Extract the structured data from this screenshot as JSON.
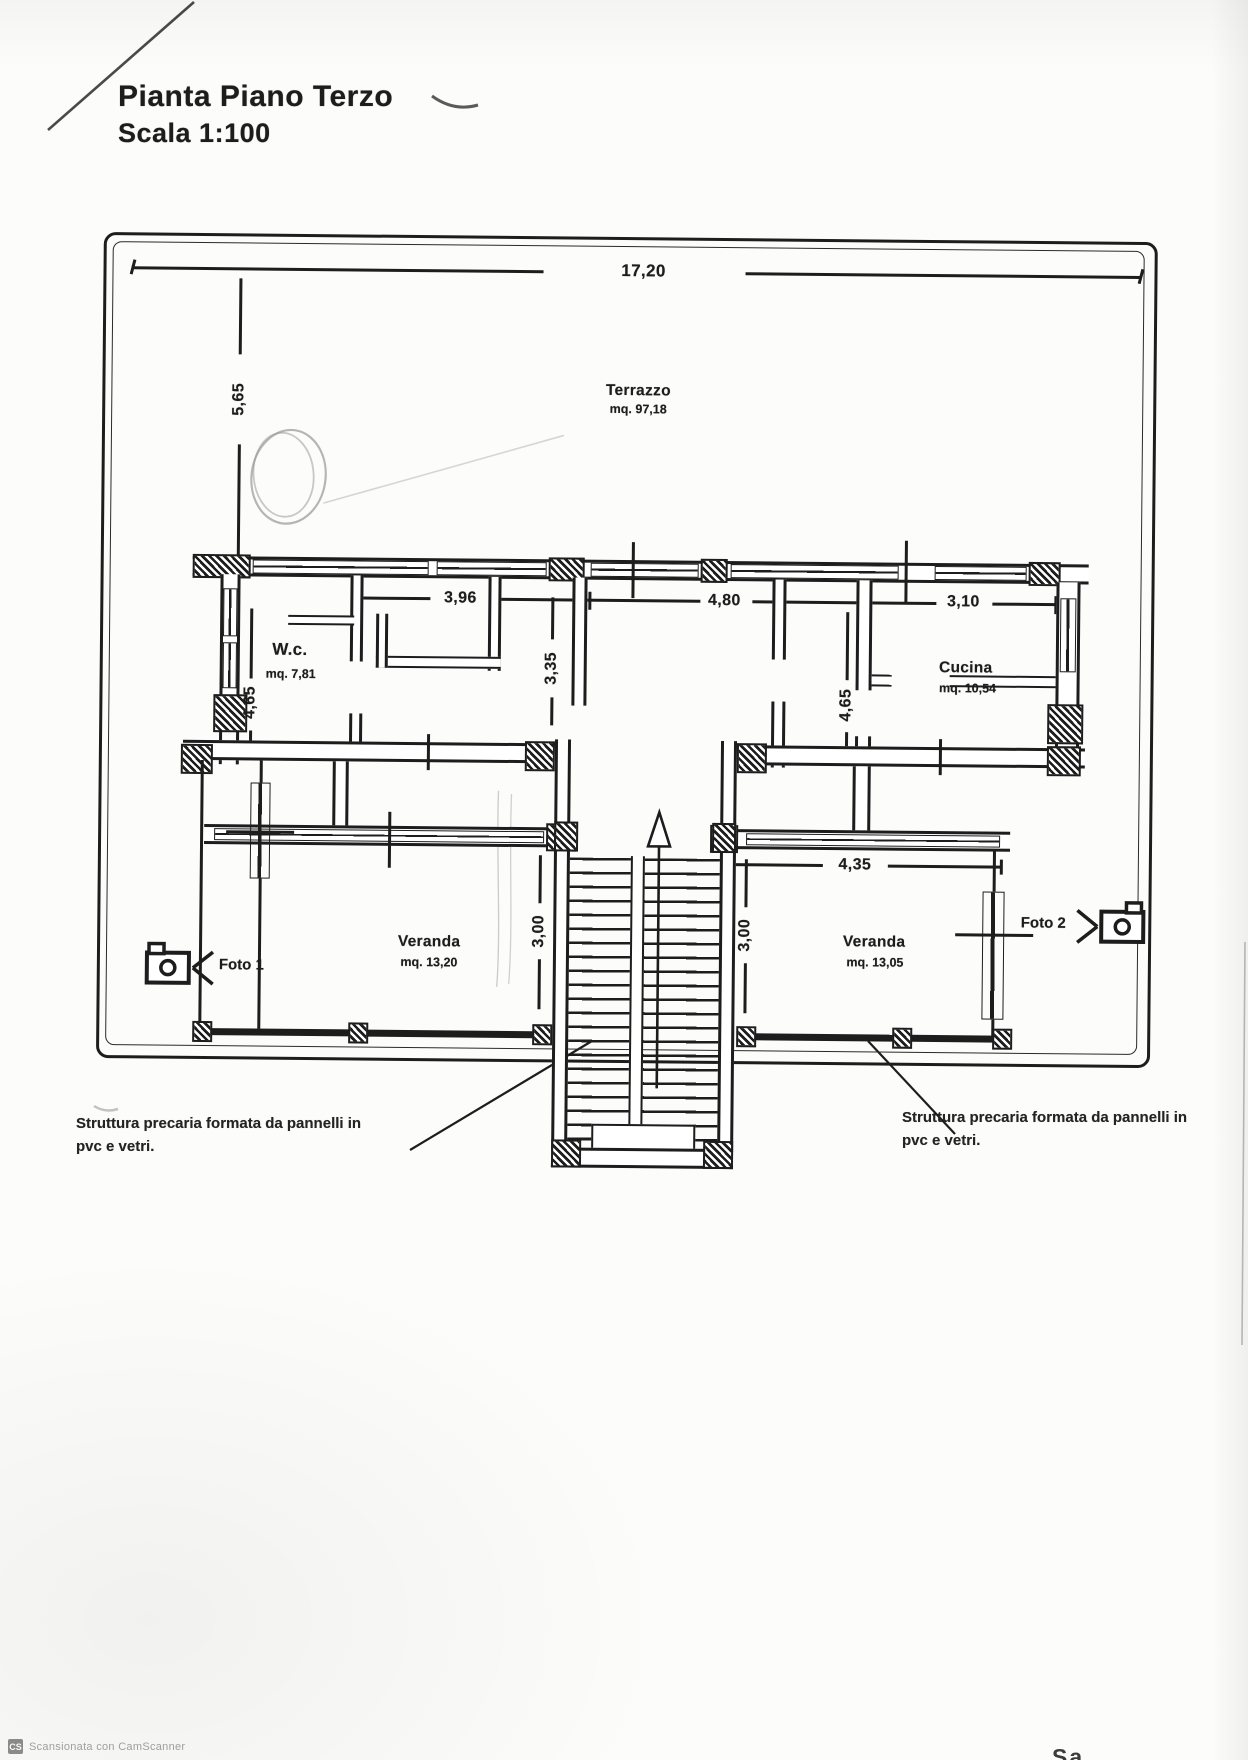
{
  "document": {
    "title": "Pianta Piano Terzo",
    "scale": "Scala 1:100"
  },
  "rooms": {
    "terrazzo": {
      "name": "Terrazzo",
      "area": "mq. 97,18"
    },
    "wc": {
      "name": "W.c.",
      "area": "mq. 7,81"
    },
    "cucina": {
      "name": "Cucina",
      "area": "mq. 10,54"
    },
    "veranda_left": {
      "name": "Veranda",
      "area": "mq. 13,20"
    },
    "veranda_right": {
      "name": "Veranda",
      "area": "mq. 13,05"
    }
  },
  "dimensions": {
    "terrace_width": "17,20",
    "terrace_depth": "5,65",
    "room_left_width": "3,96",
    "room_left_depth": "3,35",
    "room_center_width": "4,80",
    "cucina_width": "3,10",
    "wc_depth": "4,65",
    "hall_depth": "4,65",
    "veranda_right_width": "4,35",
    "veranda_left_depth": "3,00",
    "veranda_right_depth": "3,00"
  },
  "photos": {
    "foto1": "Foto 1",
    "foto2": "Foto 2"
  },
  "annotations": {
    "left_line1": "Struttura precaria formata da pannelli in",
    "left_line2": "pvc e vetri.",
    "right_line1": "Struttura precaria formata da pannelli in",
    "right_line2": "pvc e vetri."
  },
  "scanner": {
    "logo": "CS",
    "label": "Scansionata con CamScanner"
  },
  "artifacts": {
    "corner_fragment": "Sa"
  },
  "colors": {
    "ink": "#1d1d1d",
    "paper": "#fcfcfa",
    "pencil": "#9a9a9a"
  }
}
